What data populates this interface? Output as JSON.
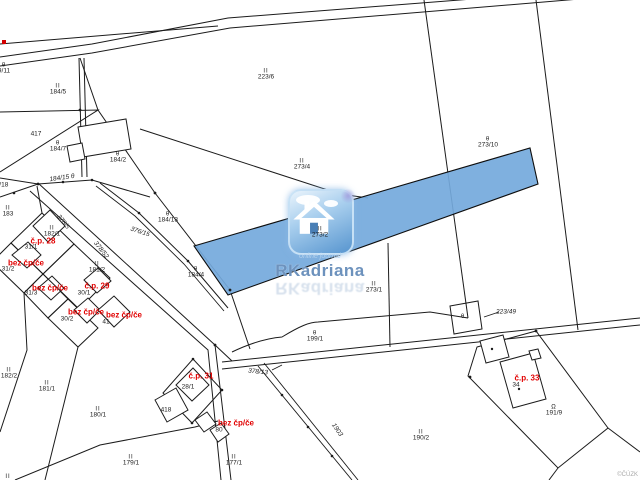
{
  "map": {
    "copyright": "©ČÚZK",
    "highlighted_parcel": "273/2"
  },
  "watermark": {
    "brand": "RKadriana",
    "tagline": "online journal"
  },
  "colors": {
    "highlight_fill": "#74a9dc",
    "line": "#1b1b1b",
    "red_label": "#e10000",
    "red_marker": "#d40000",
    "brand_text": "#6d92bd",
    "tagline_text": "#b5d2ed",
    "copyright_text": "#a9a9a9",
    "logo_top": "#eaf4fc",
    "logo_mid": "#a9cfee",
    "logo_bottom": "#5795cf"
  },
  "parcel_labels": [
    {
      "sym": "θ",
      "num": "9/11",
      "x": 4,
      "y": 69
    },
    {
      "sym": "II",
      "num": "184/5",
      "x": 58,
      "y": 90
    },
    {
      "sym": "",
      "num": "417",
      "x": 36,
      "y": 135
    },
    {
      "sym": "θ",
      "num": "184/7",
      "x": 58,
      "y": 147
    },
    {
      "sym": "θ",
      "num": "184/2",
      "x": 118,
      "y": 158
    },
    {
      "sym": "II",
      "num": "223/6",
      "x": 266,
      "y": 75
    },
    {
      "sym": "θ",
      "num": "273/10",
      "x": 488,
      "y": 143
    },
    {
      "sym": "II",
      "num": "273/4",
      "x": 302,
      "y": 165
    },
    {
      "sym": "II",
      "num": "183",
      "x": 8,
      "y": 212
    },
    {
      "sym": "II",
      "num": "182/1",
      "x": 52,
      "y": 232
    },
    {
      "sym": "θ",
      "num": "184/13",
      "x": 168,
      "y": 218
    },
    {
      "sym": "θ",
      "num": "184/4",
      "x": 196,
      "y": 273
    },
    {
      "sym": "II",
      "num": "273/2",
      "x": 320,
      "y": 233
    },
    {
      "sym": "II",
      "num": "273/1",
      "x": 374,
      "y": 288
    },
    {
      "sym": "",
      "num": "4/18",
      "x": 2,
      "y": 186
    },
    {
      "sym": "",
      "num": "31/1",
      "x": 31,
      "y": 248
    },
    {
      "sym": "",
      "num": "31/2",
      "x": 8,
      "y": 270
    },
    {
      "sym": "",
      "num": "31/3",
      "x": 31,
      "y": 294
    },
    {
      "sym": "",
      "num": "30/1",
      "x": 84,
      "y": 294
    },
    {
      "sym": "",
      "num": "30/2",
      "x": 67,
      "y": 320
    },
    {
      "sym": "",
      "num": "41",
      "x": 106,
      "y": 323
    },
    {
      "sym": "II",
      "num": "181/2",
      "x": 97,
      "y": 268
    },
    {
      "sym": "II",
      "num": "182/2",
      "x": 9,
      "y": 374
    },
    {
      "sym": "II",
      "num": "181/1",
      "x": 47,
      "y": 387
    },
    {
      "sym": "II",
      "num": "180/1",
      "x": 98,
      "y": 413
    },
    {
      "sym": "II",
      "num": "179/1",
      "x": 131,
      "y": 461
    },
    {
      "sym": "",
      "num": "28/1",
      "x": 188,
      "y": 388
    },
    {
      "sym": "",
      "num": "418",
      "x": 166,
      "y": 411
    },
    {
      "sym": "",
      "num": "80",
      "x": 219,
      "y": 431
    },
    {
      "sym": "II",
      "num": "177/1",
      "x": 234,
      "y": 461
    },
    {
      "sym": "θ",
      "num": "199/1",
      "x": 315,
      "y": 337
    },
    {
      "sym": "θ",
      "num": "",
      "x": 463,
      "y": 317
    },
    {
      "sym": "",
      "num": "34",
      "x": 516,
      "y": 386
    },
    {
      "sym": "Ω",
      "num": "191/9",
      "x": 554,
      "y": 411
    },
    {
      "sym": "II",
      "num": "190/2",
      "x": 421,
      "y": 436
    },
    {
      "sym": "II",
      "num": "",
      "x": 8,
      "y": 477
    }
  ],
  "road_labels": [
    {
      "num": "378/5",
      "x": 63,
      "y": 222,
      "rot": 52
    },
    {
      "num": "378/52",
      "x": 101,
      "y": 250,
      "rot": 52
    },
    {
      "num": "376/15",
      "x": 140,
      "y": 232,
      "rot": 18
    },
    {
      "num": "184/15 θ",
      "x": 62,
      "y": 178,
      "rot": -8
    },
    {
      "num": "378/13",
      "x": 258,
      "y": 372,
      "rot": 6
    },
    {
      "num": "223/49",
      "x": 506,
      "y": 312,
      "rot": 0
    },
    {
      "num": "1903",
      "x": 337,
      "y": 430,
      "rot": 55
    }
  ],
  "red_labels": [
    {
      "text": "č.p. 28",
      "x": 43,
      "y": 241
    },
    {
      "text": "bez čp/če",
      "x": 26,
      "y": 263
    },
    {
      "text": "bez čp/če",
      "x": 50,
      "y": 288
    },
    {
      "text": "č.p. 29",
      "x": 97,
      "y": 286
    },
    {
      "text": "bez čp/če",
      "x": 86,
      "y": 312
    },
    {
      "text": "bez čp/če",
      "x": 124,
      "y": 315
    },
    {
      "text": "č.p. 31",
      "x": 201,
      "y": 376
    },
    {
      "text": "bez čp/če",
      "x": 236,
      "y": 423
    },
    {
      "text": "č.p. 33",
      "x": 527,
      "y": 378
    }
  ]
}
